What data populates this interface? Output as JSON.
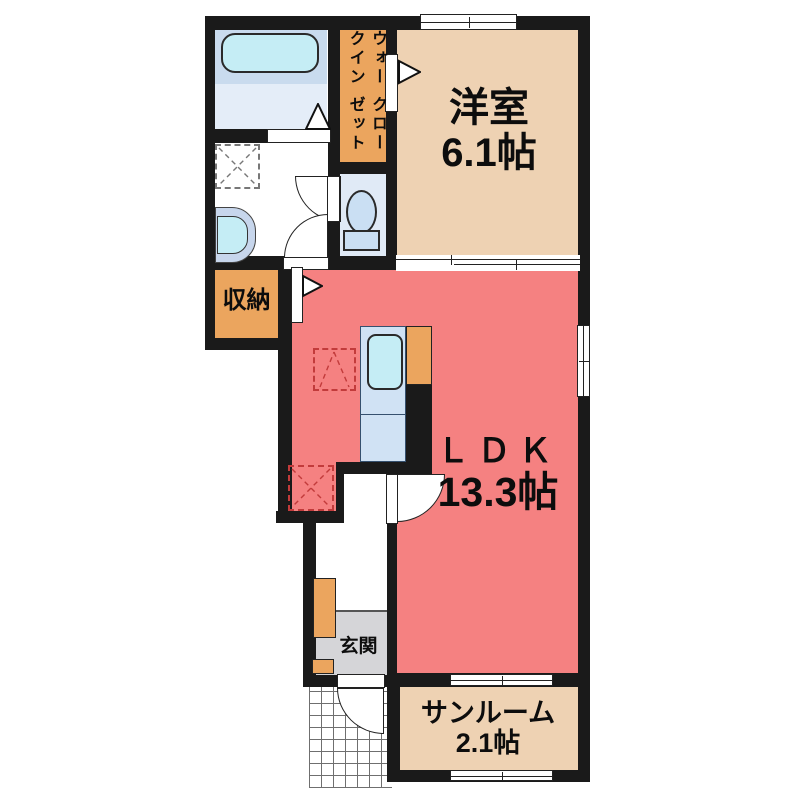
{
  "rooms": {
    "western": {
      "name": "洋室",
      "area": "6.1帖"
    },
    "ldk": {
      "name": "ＬＤＫ",
      "area": "13.3帖"
    },
    "sunroom": {
      "name": "サンルーム",
      "area": "2.1帖"
    },
    "storage": {
      "name": "収納"
    },
    "entrance": {
      "name": "玄関"
    },
    "wic": {
      "line1": "ウォークイン",
      "line2": "クローゼット"
    }
  },
  "colors": {
    "wall": "#1a1a1a",
    "room_tan": "#eed2b3",
    "room_salmon": "#f58181",
    "closet_orange": "#eba55e",
    "bath_blue": "#c9dbee",
    "bath_light": "#e4edf8",
    "toilet_blue": "#e0eaf6",
    "fixture_cyan": "#c5edf5",
    "fixture_blue": "#cadff3",
    "counter_blue": "#d0e2f4",
    "basin_gray": "#c7d6ec",
    "genkan_gray": "#d5d5d8",
    "appliance_red": "#c23b3b"
  }
}
